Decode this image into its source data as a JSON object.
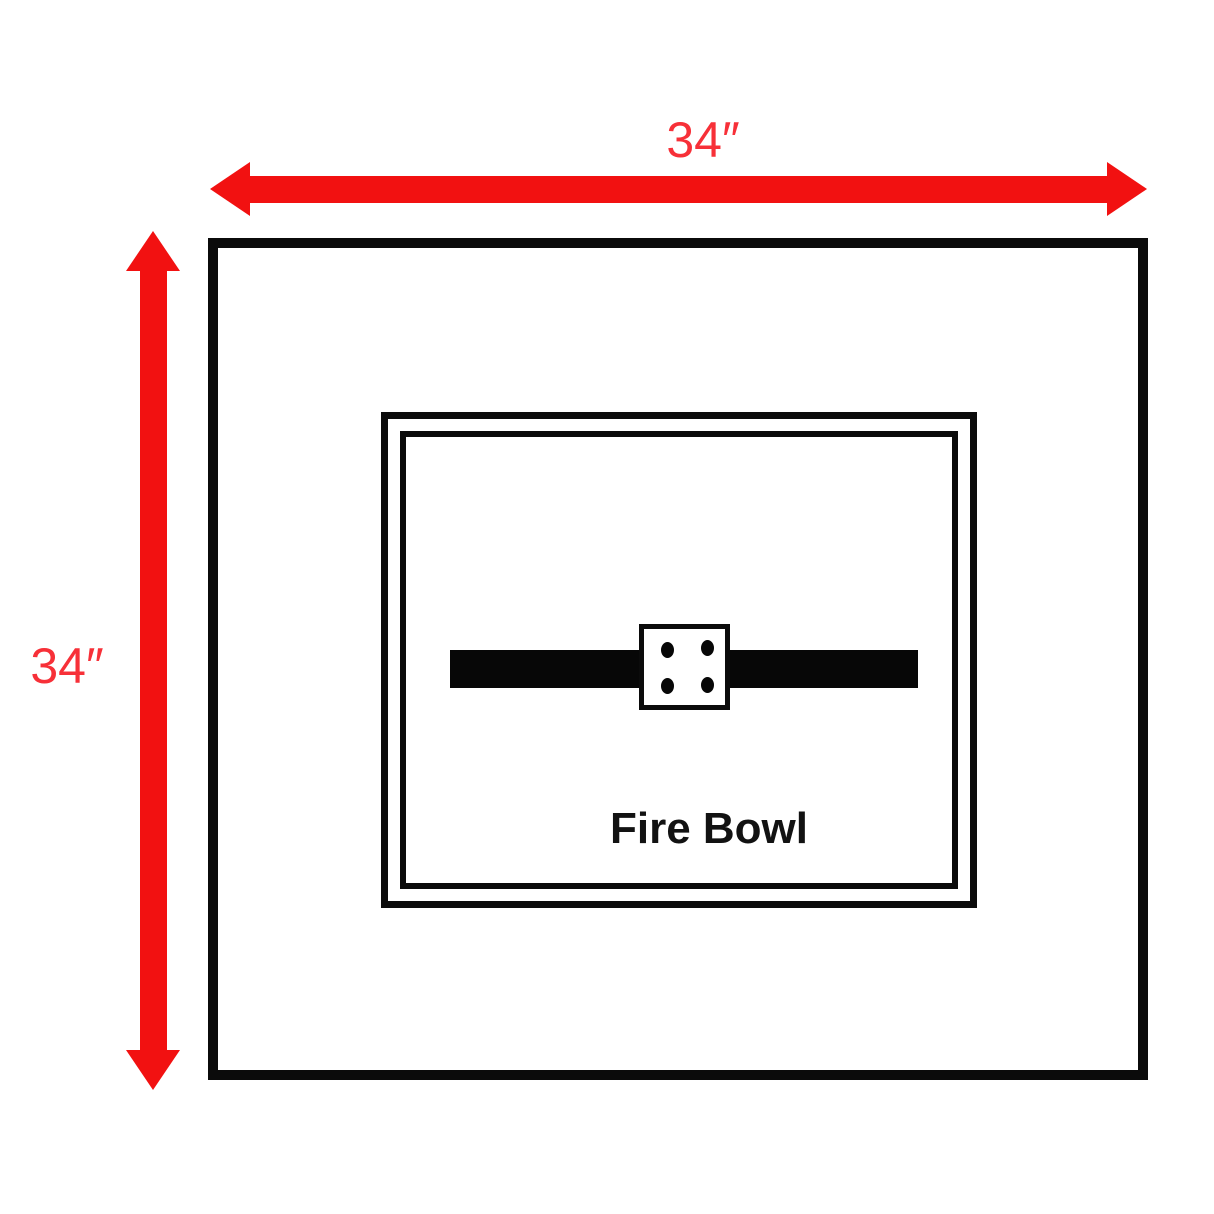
{
  "diagram": {
    "type": "dimension-diagram",
    "subject": "Fire bowl enclosure top view",
    "labels": {
      "width": "34″",
      "height": "34″",
      "fire_bowl": "Fire Bowl"
    },
    "dimensions": {
      "width_value": "34 inches",
      "height_value": "34 inches"
    },
    "burner": {
      "port_count": 4
    },
    "colors": {
      "dimension_arrow": "#f21111",
      "dimension_label": "#f73038",
      "outline": "#0b0b0b",
      "background": "#ffffff"
    }
  }
}
